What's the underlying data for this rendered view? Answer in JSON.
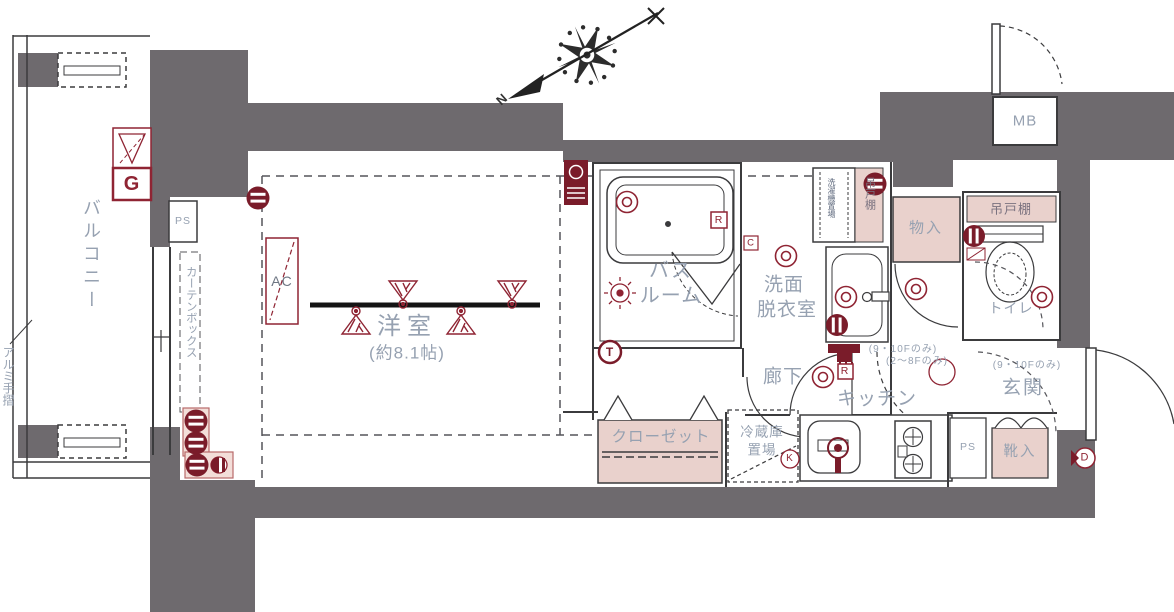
{
  "colors": {
    "wall": "#6e6a6e",
    "line": "#3b3b3d",
    "pink": "#e9d1cc",
    "red": "#8f2433",
    "dark_red": "#7a1c2a",
    "label": "#96a1b1"
  },
  "compass": {
    "north": "N"
  },
  "balcony": {
    "label": "バルコニー",
    "handrail": "アルミ手摺"
  },
  "living_room": {
    "label": "洋室",
    "size": "(約8.1帖)",
    "curtain_box": "カーテンボックス",
    "ac": "AC",
    "gas_meter": "G",
    "pipe_space": "PS"
  },
  "bathroom": {
    "label_line1": "バス",
    "label_line2": "ルーム",
    "remote": "R",
    "c_mark": "C",
    "t_mark": "T"
  },
  "washroom": {
    "label_line1": "洗面",
    "label_line2": "脱衣室",
    "laundry": "洗濯機置場",
    "cupboard": "吊戸棚"
  },
  "hallway": {
    "label": "廊下",
    "r_mark": "R",
    "note_9_10f": "(9・10Fのみ)",
    "note_2_8f": "(2〜8Fのみ)"
  },
  "kitchen": {
    "label": "キッチン",
    "fridge_line1": "冷蔵庫",
    "fridge_line2": "置場",
    "pipe_space": "PS",
    "k_mark": "K"
  },
  "closet": {
    "label": "クローゼット"
  },
  "storage": {
    "label": "物入"
  },
  "toilet": {
    "label": "トイレ",
    "cupboard": "吊戸棚"
  },
  "entrance": {
    "label": "玄関",
    "note_9_10f": "(9・10Fのみ)",
    "shoe_box": "靴入",
    "d_mark": "D"
  },
  "meter_box": {
    "label": "MB"
  }
}
